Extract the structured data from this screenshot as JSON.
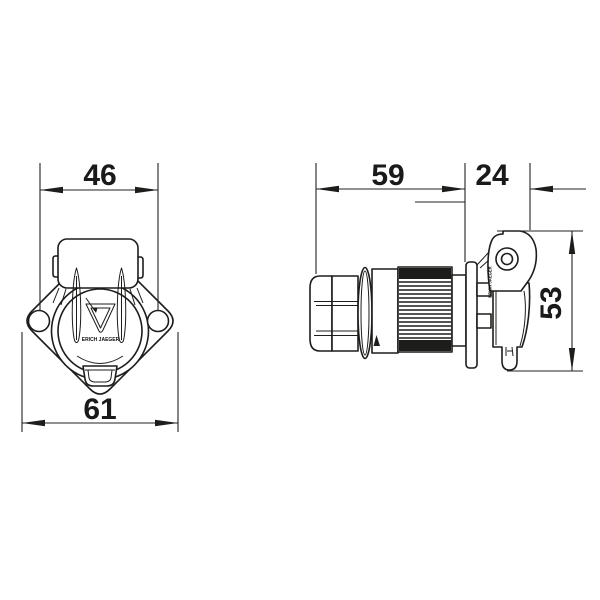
{
  "dims": {
    "hole_spacing": "46",
    "flange_width": "61",
    "body_length": "59",
    "lid_depth": "24",
    "height": "53"
  },
  "branding": {
    "logo_text": "ERICH JAEGER",
    "lid_marking": "ERICH JAEGER"
  },
  "colors": {
    "line": "#1d1d1b",
    "background": "#ffffff"
  }
}
